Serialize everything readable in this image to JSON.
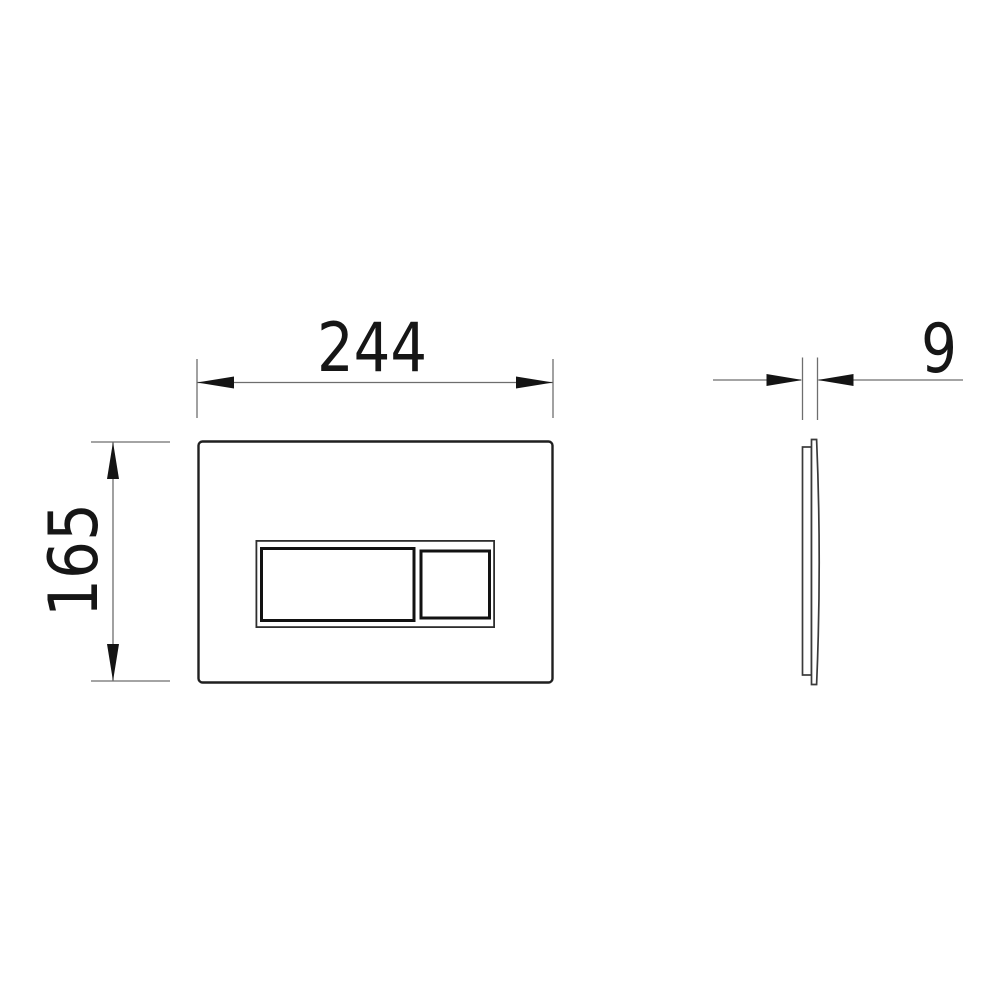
{
  "drawing": {
    "labels": {
      "width": "244",
      "height": "165",
      "depth": "9"
    },
    "colors": {
      "background": "#ffffff",
      "object_line": "#1f1f1f",
      "button_line": "#121212",
      "dimension_line": "#6e6e6e",
      "arrow": "#141414",
      "text": "#161616"
    }
  }
}
